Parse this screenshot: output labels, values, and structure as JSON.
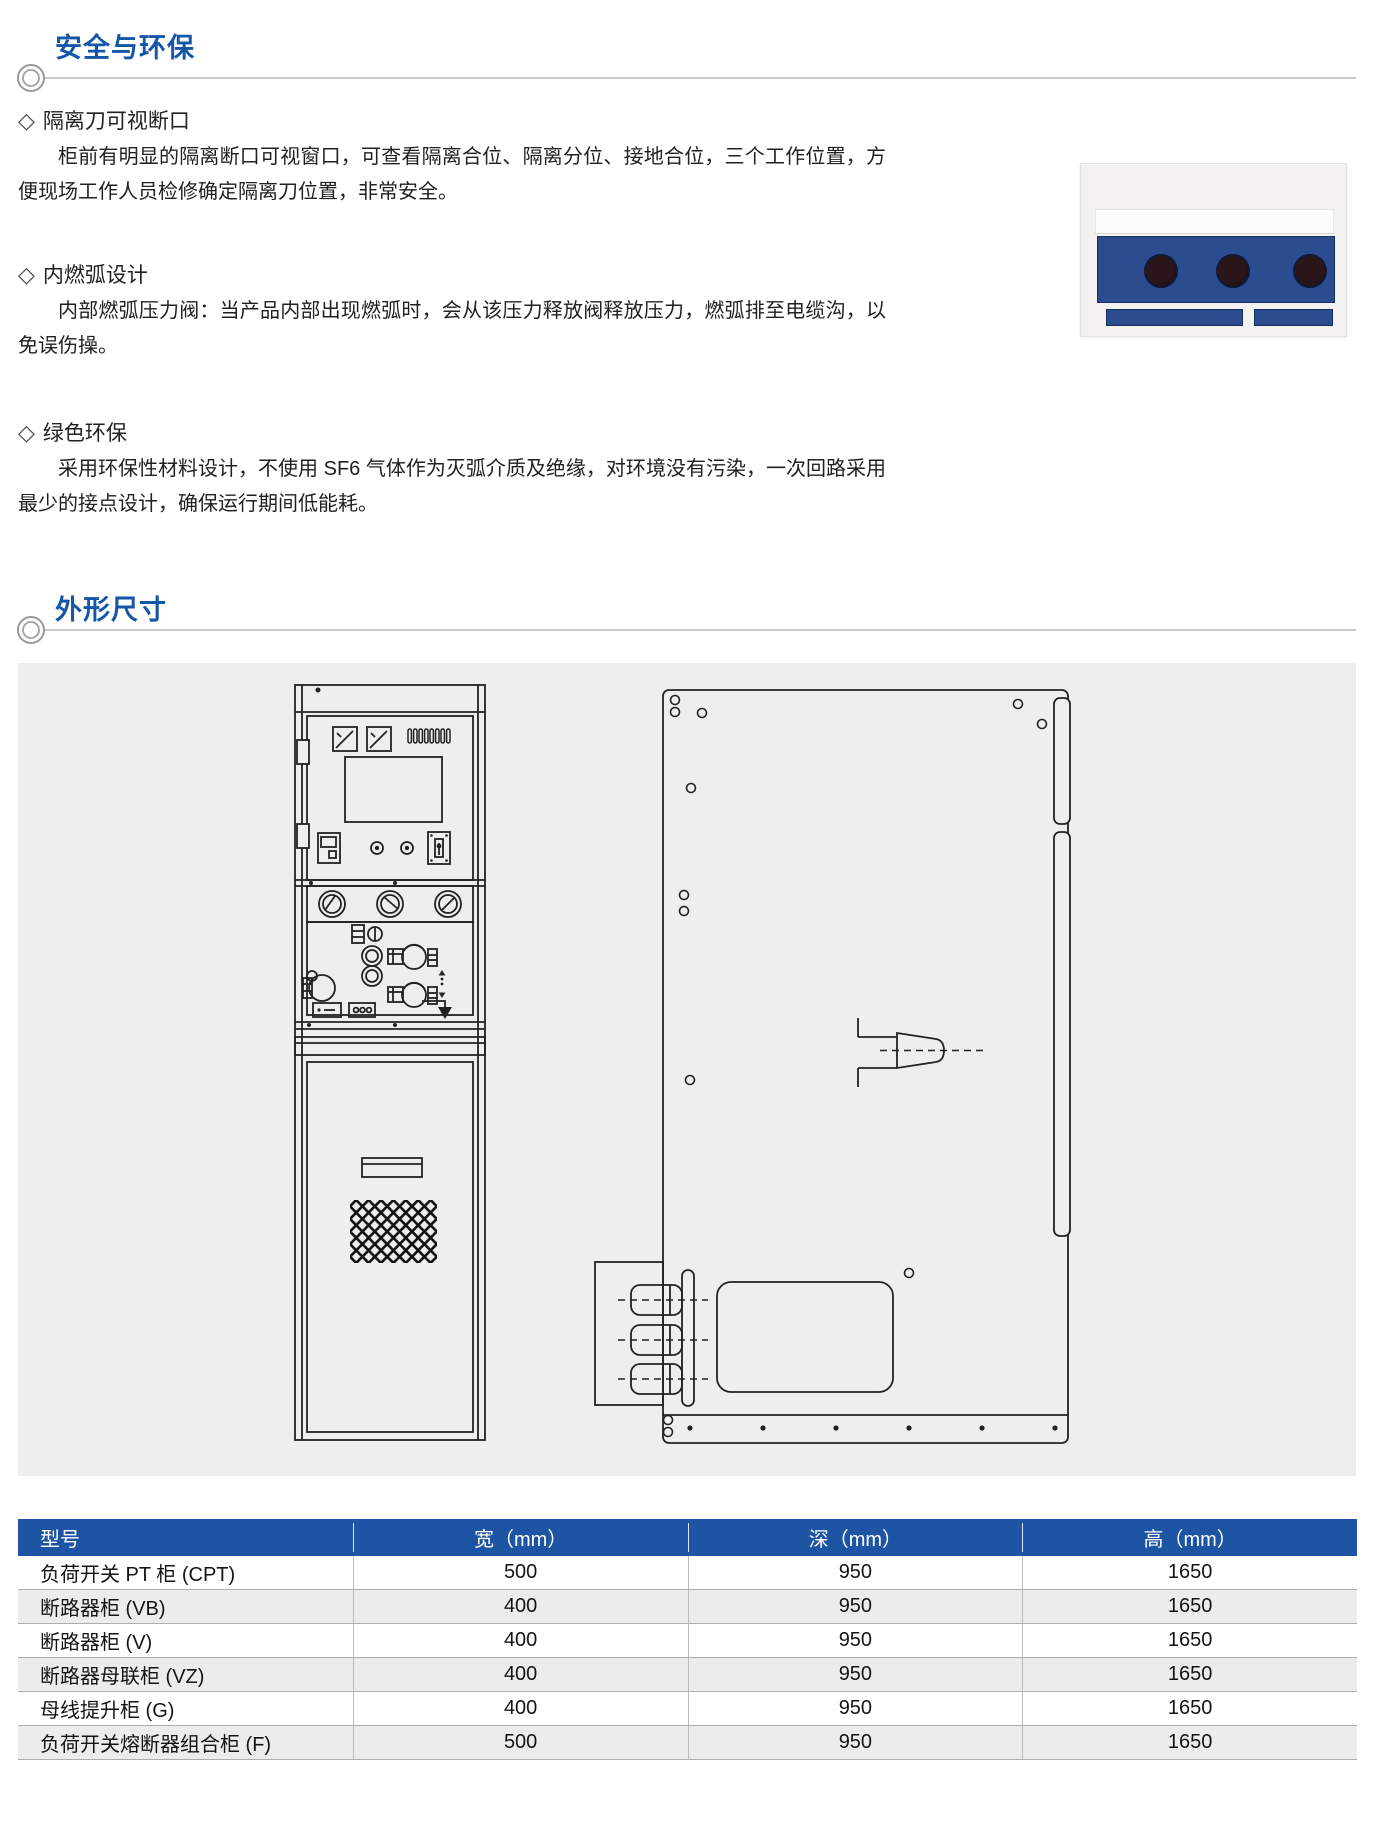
{
  "safety": {
    "title": "安全与环保",
    "bullet": "◇",
    "items": [
      {
        "heading": "隔离刀可视断口",
        "body": "柜前有明显的隔离断口可视窗口，可查看隔离合位、隔离分位、接地合位，三个工作位置，方便现场工作人员检修确定隔离刀位置，非常安全。"
      },
      {
        "heading": "内燃弧设计",
        "body": "内部燃弧压力阀：当产品内部出现燃弧时，会从该压力释放阀释放压力，燃弧排至电缆沟，以免误伤操。"
      },
      {
        "heading": "绿色环保",
        "body": "采用环保性材料设计，不使用 SF6 气体作为灭弧介质及绝缘，对环境没有污染，一次回路采用最少的接点设计，确保运行期间低能耗。"
      }
    ]
  },
  "dimensions": {
    "title": "外形尺寸"
  },
  "table": {
    "headers": [
      "型号",
      "宽（mm）",
      "深（mm）",
      "高（mm）"
    ],
    "rows": [
      [
        "负荷开关 PT 柜 (CPT)",
        "500",
        "950",
        "1650"
      ],
      [
        "断路器柜 (VB)",
        "400",
        "950",
        "1650"
      ],
      [
        "断路器柜 (V)",
        "400",
        "950",
        "1650"
      ],
      [
        "断路器母联柜 (VZ)",
        "400",
        "950",
        "1650"
      ],
      [
        "母线提升柜 (G)",
        "400",
        "950",
        "1650"
      ],
      [
        "负荷开关熔断器组合柜 (F)",
        "500",
        "950",
        "1650"
      ]
    ]
  },
  "colors": {
    "accent_blue": "#1456a8",
    "table_header_bg": "#1d55a4",
    "table_header_text": "#ffffff",
    "row_alt_bg": "#ececec",
    "photo_blue": "#2b4d90",
    "drawing_bg": "#eeefed"
  }
}
